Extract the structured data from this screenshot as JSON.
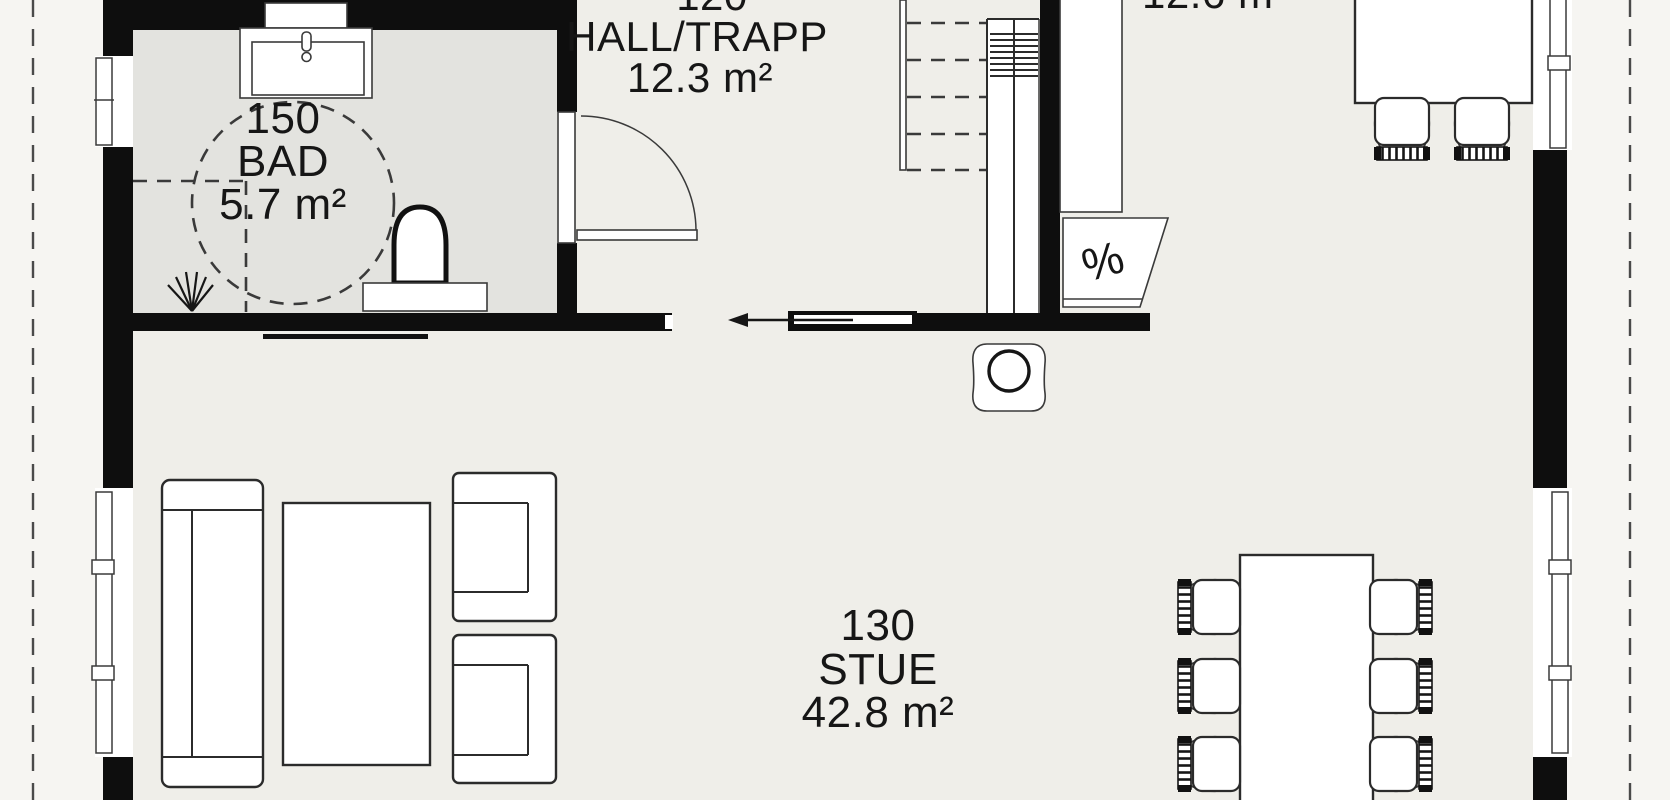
{
  "rooms": [
    {
      "number": "150",
      "name": "BAD",
      "area": "5.7 m²"
    },
    {
      "number": "120",
      "name": "HALL/TRAPP",
      "area": "12.3 m²"
    },
    {
      "number": "130",
      "name": "STUE",
      "area": "42.8 m²"
    }
  ],
  "clipped_labels": {
    "kitchen_area": "12.6 m²"
  },
  "symbols": {
    "dishwasher": "%"
  },
  "colors": {
    "wall": "#0e0e0e",
    "interior_floor": "#efeee9",
    "bathroom_floor": "#e3e3df",
    "exterior": "#f6f5f2",
    "line": "#2b2b2b"
  }
}
